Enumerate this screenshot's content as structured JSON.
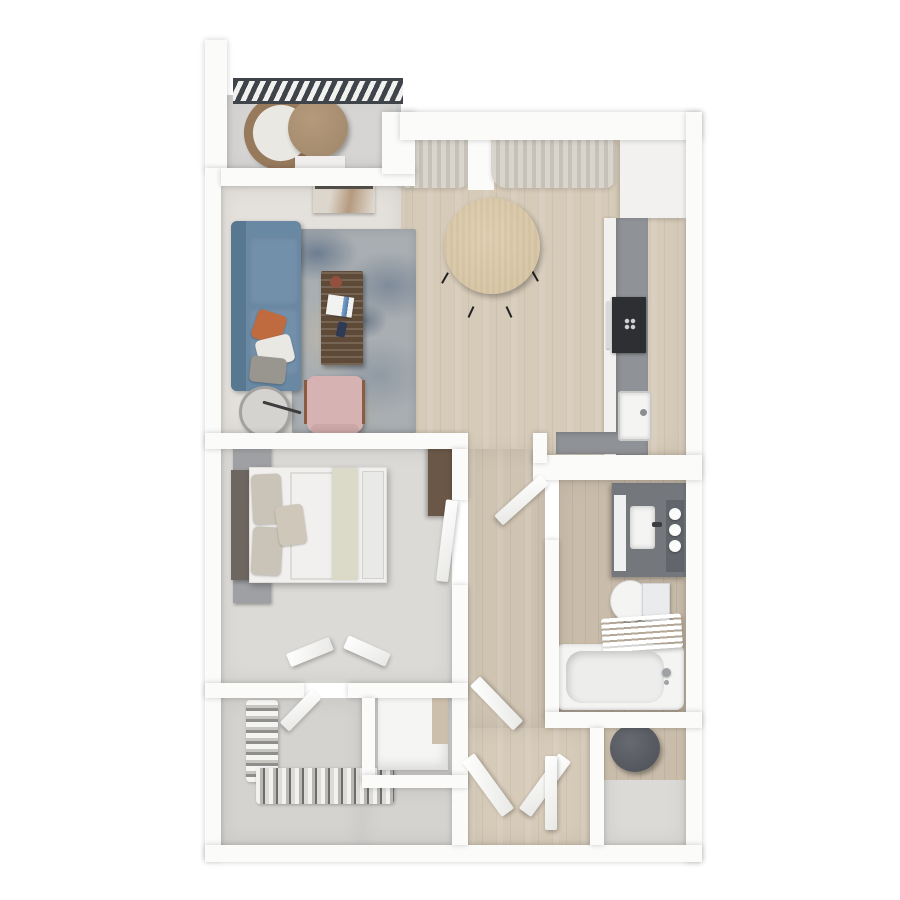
{
  "scene": {
    "description": "Top-down 3D architectural render of a one-bedroom, one-bathroom apartment floor plan with balcony",
    "view": "top-down",
    "style": "photoreal-3d-floorplan",
    "text_visible": "none"
  },
  "colors": {
    "bg": "#ffffff",
    "wall": "#fbfbfa",
    "wood": "#d6cab8",
    "wood-hall": "#cfc3b1",
    "bath-floor": "#c9bcaa",
    "bedroom-floor": "#dcdad6",
    "closet-floor": "#d5d3d0",
    "living-floor": "#e4e0db",
    "balcony-floor": "#d6d5d3",
    "railing": "#3f444b",
    "rug-base": "#a9aeb2",
    "sofa": "#6888a4",
    "sofa-dark": "#587791",
    "cushion": "#7390ab",
    "pillow-orange": "#c06a3f",
    "pillow-white": "#eae8e3",
    "pillow-gray": "#98968f",
    "coffee-table": "#5f4a38",
    "armchair-pink": "#d6b2b2",
    "armchair-frame": "#8a5c42",
    "side-table": "#d4d3d0",
    "console": "#ddd6cc",
    "console-wood": "#b59a7e",
    "curtain": "#d9d5cd",
    "curtain-shade": "#c6c2ba",
    "dining-table": "#d8c7a6",
    "dining-chair": "#5c6d9d",
    "counter": "#8f9296",
    "cabinet": "#f2f1f0",
    "cooktop": "#2d2f33",
    "sink-white": "#f4f4f3",
    "headboard": "#6e6660",
    "bedding": "#f1f0ee",
    "pillow-beige": "#c9c3b8",
    "runner": "#dbdac9",
    "nightstand": "#9fa0a3",
    "lamp": "#43434a",
    "lamp-gold": "#c29544",
    "dresser": "#6a5747",
    "vanity": "#74787d",
    "towel-shelf": "#62666c",
    "tank": "#e9ebec",
    "utility-drum": "#54585e",
    "table-wicker": "#a68c6e",
    "chair-wicker": "#97795c"
  },
  "rooms": [
    {
      "label": "Balcony",
      "furniture": [
        "railing",
        "round-wicker-chair",
        "round-bistro-table"
      ]
    },
    {
      "label": "Living Room",
      "furniture": [
        "blue-sofa",
        "area-rug",
        "coffee-table",
        "pink-armchair",
        "round-side-table",
        "media-console",
        "throw-pillows"
      ]
    },
    {
      "label": "Dining Area",
      "furniture": [
        "round-dining-table",
        "four-blue-chairs",
        "curtains"
      ]
    },
    {
      "label": "Kitchen",
      "furniture": [
        "tall-cabinets",
        "galley-counter",
        "cooktop-oven",
        "kitchen-sink"
      ]
    },
    {
      "label": "Bedroom",
      "furniture": [
        "double-bed",
        "two-nightstands",
        "two-lamps",
        "dresser"
      ]
    },
    {
      "label": "Walk-in Closet",
      "furniture": [
        "hanging-clothes-left",
        "hanging-clothes-bottom",
        "closet-door"
      ]
    },
    {
      "label": "Laundry Nook",
      "furniture": [
        "white-cabinet"
      ]
    },
    {
      "label": "Bathroom",
      "furniture": [
        "vanity-with-sink",
        "toilet",
        "bathtub",
        "towel-ladder",
        "rolled-towels"
      ]
    },
    {
      "label": "Utility Room",
      "furniture": [
        "water-heater"
      ]
    },
    {
      "label": "Hallway",
      "furniture": [
        "open-doors"
      ]
    }
  ]
}
